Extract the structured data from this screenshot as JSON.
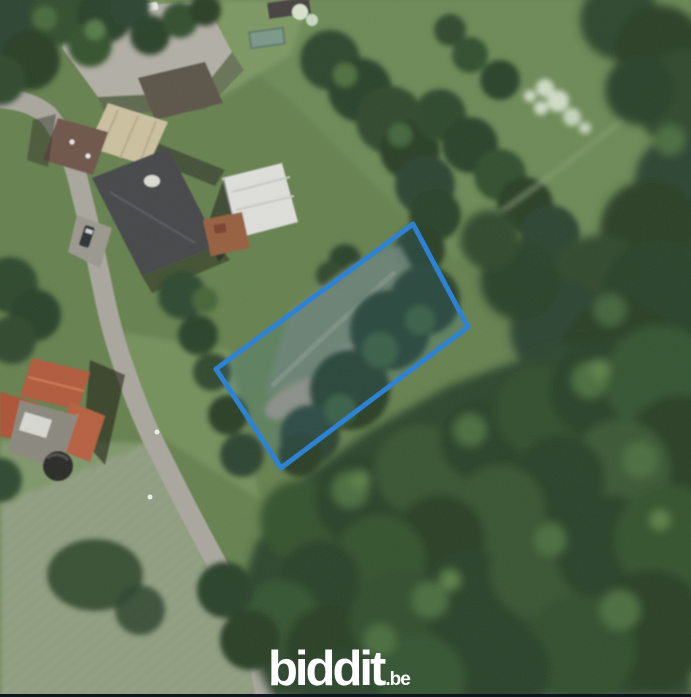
{
  "logo": {
    "brand": "biddit",
    "tld": ".be",
    "color": "#ffffff"
  },
  "map": {
    "view": "aerial-photo",
    "parcel": {
      "points": "413,224 468,327 281,468 216,369",
      "stroke_color": "#2e82d4",
      "fill_color": "rgba(46,130,212,0.12)",
      "stroke_width": "5"
    },
    "footer_bar_color": "#0d1520"
  }
}
